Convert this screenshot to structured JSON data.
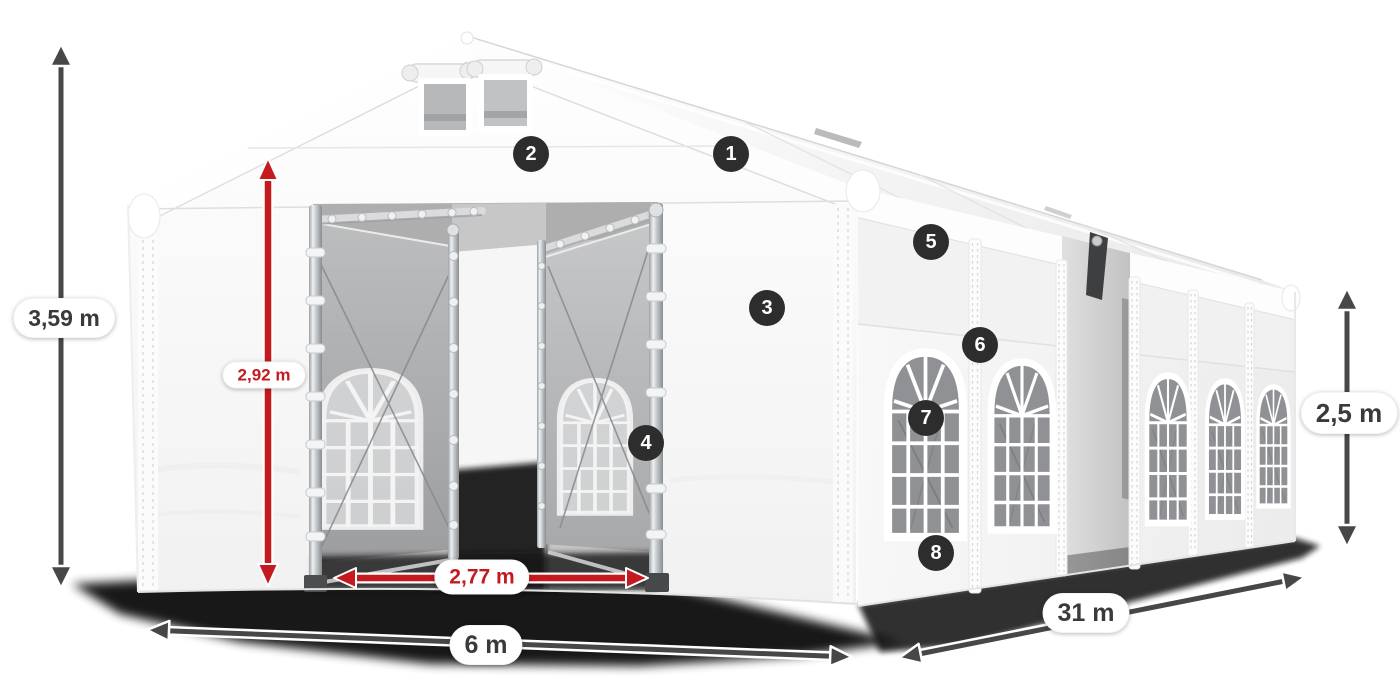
{
  "image": {
    "type": "product-dimension-diagram",
    "subject": "Large white party / storage tent with numbered feature markers and dimension arrows"
  },
  "colors": {
    "background": "#ffffff",
    "arrow_dark": "#474747",
    "accent_red": "#c4191f",
    "marker_bg": "#2d2d2d",
    "marker_text": "#ffffff",
    "pill_bg": "#ffffff",
    "dim_text_dark": "#3a3a3a",
    "tent_white": "#f7f7f7",
    "glass_gray": "#8f9194"
  },
  "dimensions": {
    "total_height": {
      "label": "3,59 m"
    },
    "entrance_height": {
      "label": "2,92 m"
    },
    "entrance_width": {
      "label": "2,77 m"
    },
    "width": {
      "label": "6 m"
    },
    "length": {
      "label": "31 m"
    },
    "side_height": {
      "label": "2,5 m"
    }
  },
  "markers": [
    {
      "label": "1"
    },
    {
      "label": "2"
    },
    {
      "label": "3"
    },
    {
      "label": "4"
    },
    {
      "label": "5"
    },
    {
      "label": "6"
    },
    {
      "label": "7"
    },
    {
      "label": "8"
    }
  ]
}
